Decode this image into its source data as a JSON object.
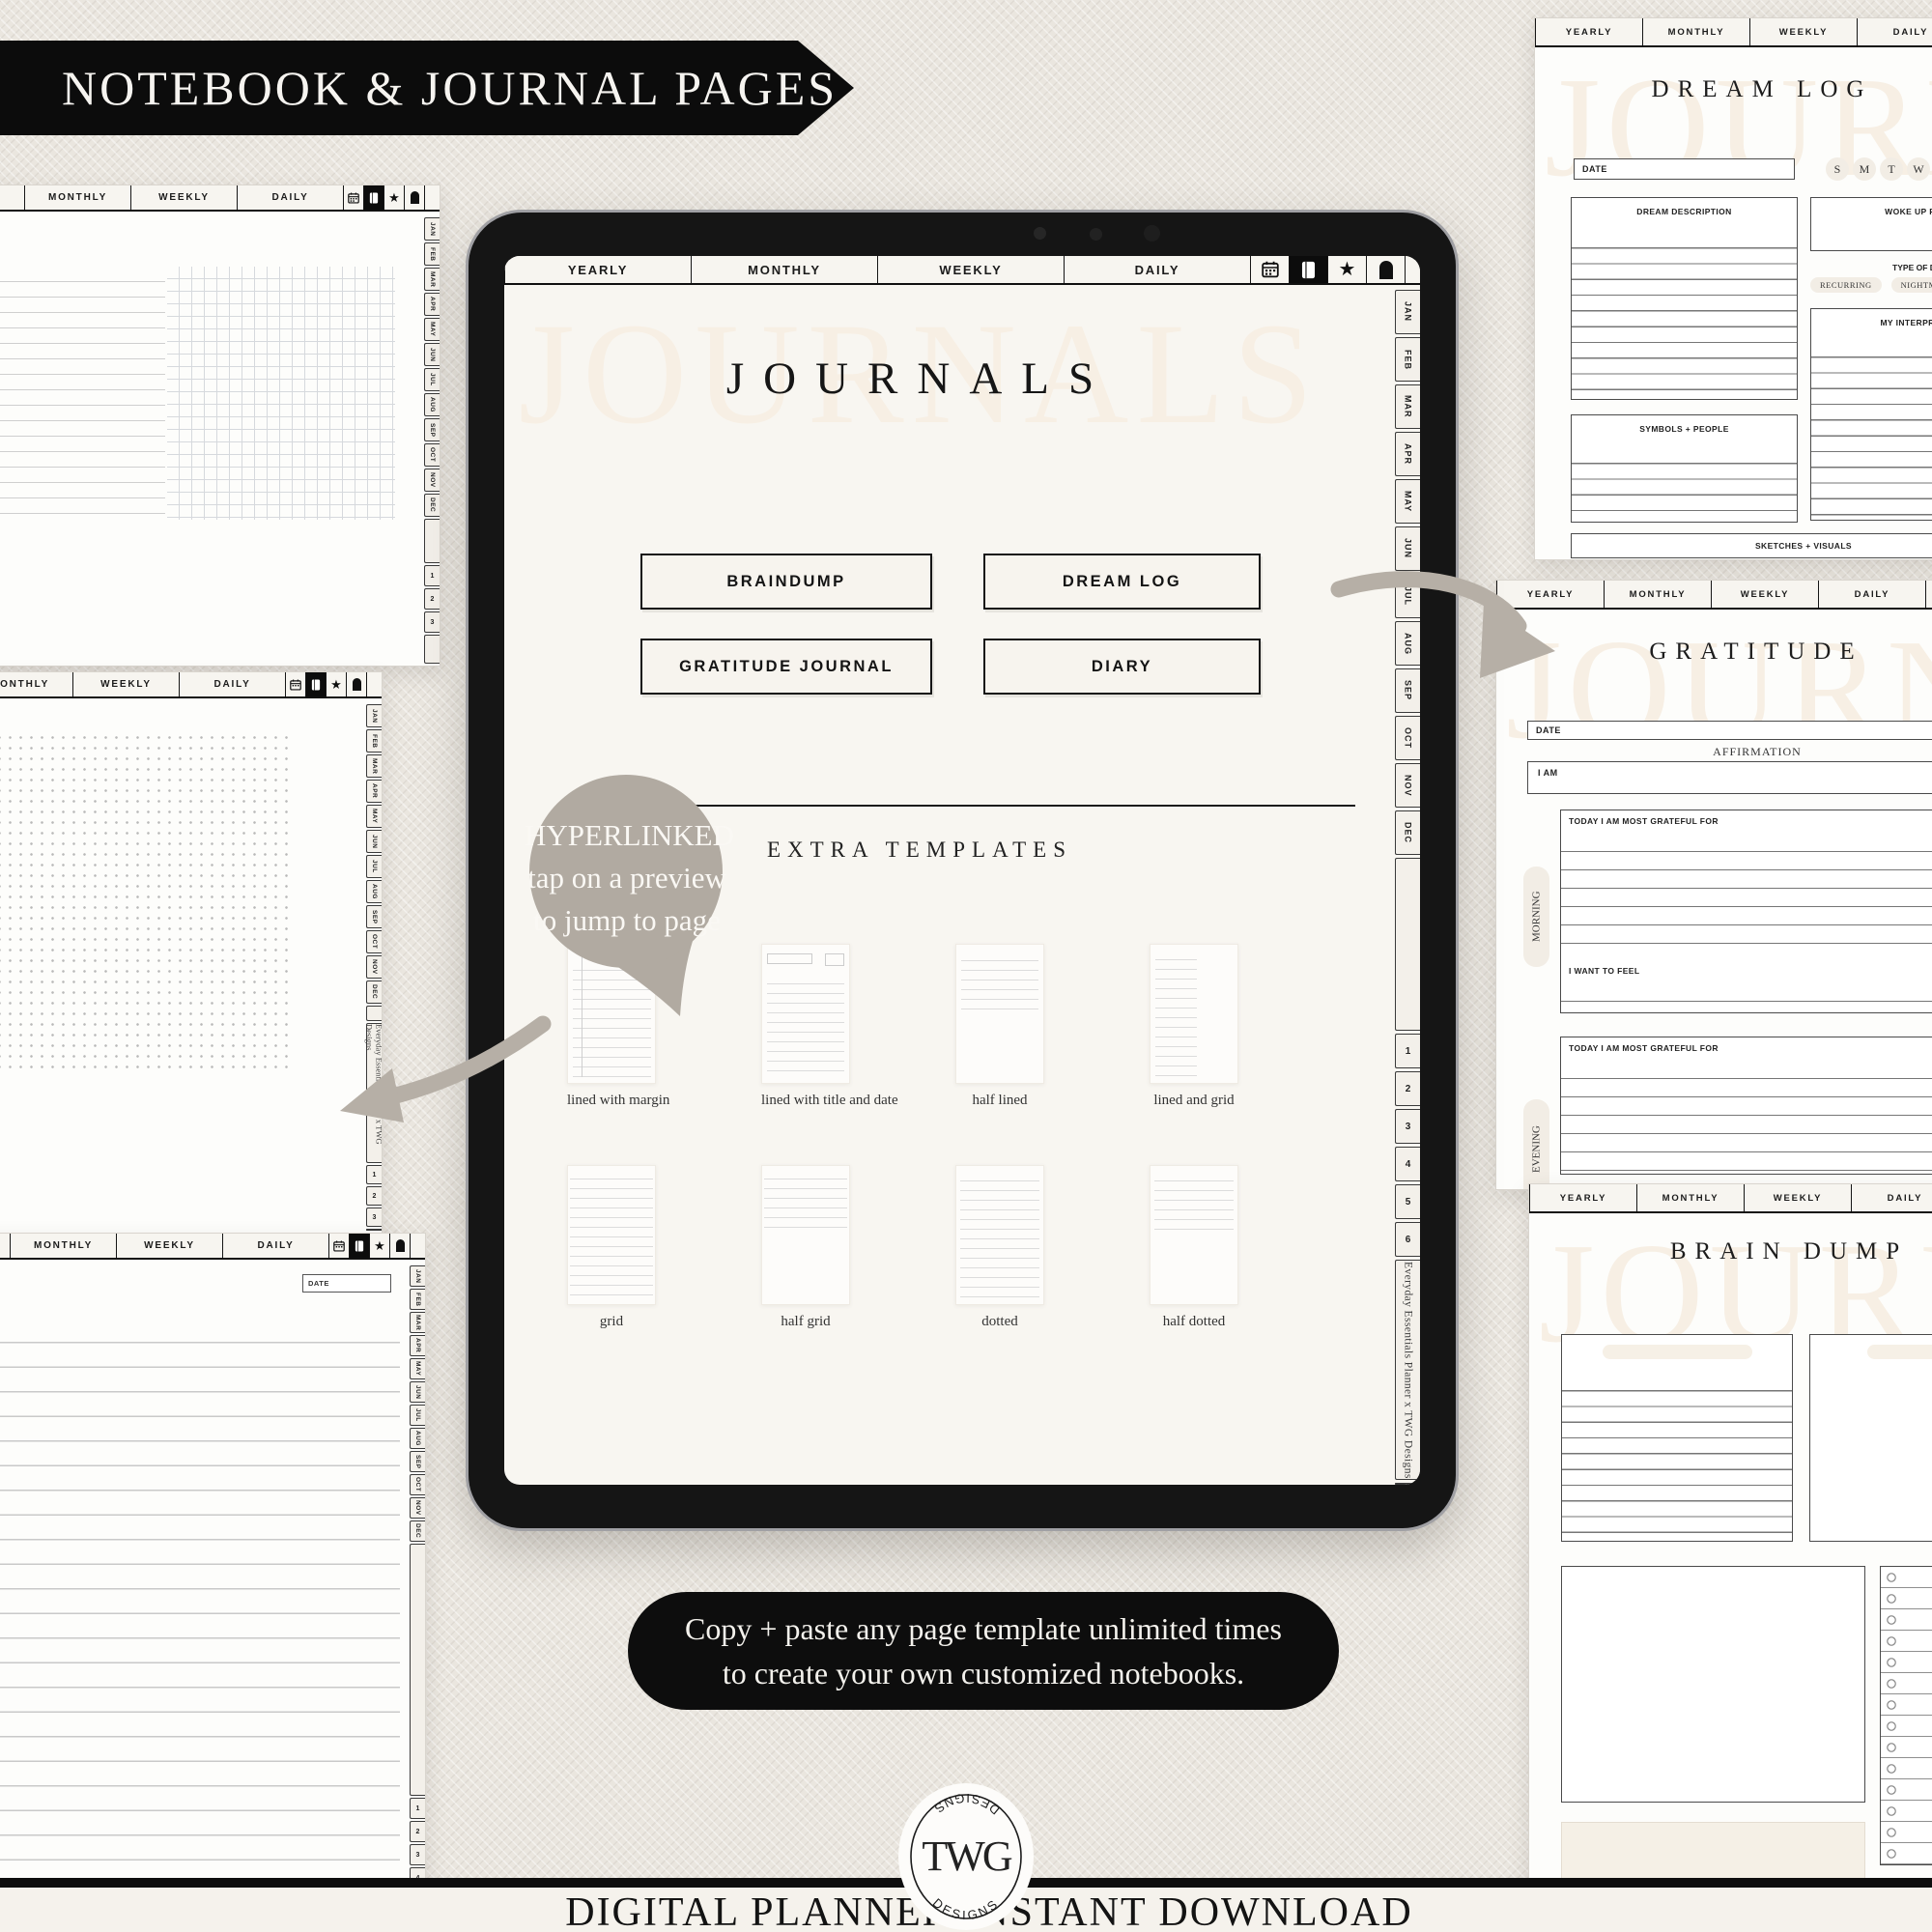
{
  "banner": {
    "title": "NOTEBOOK & JOURNAL PAGES"
  },
  "planner_tabs": [
    "YEARLY",
    "MONTHLY",
    "WEEKLY",
    "DAILY"
  ],
  "month_tabs": [
    "JAN",
    "FEB",
    "MAR",
    "APR",
    "MAY",
    "JUN",
    "JUL",
    "AUG",
    "SEP",
    "OCT",
    "NOV",
    "DEC"
  ],
  "ipad_number_tabs": [
    "1",
    "2",
    "3",
    "4",
    "5",
    "6"
  ],
  "pageb_number_tabs": [
    "1",
    "2",
    "3"
  ],
  "pagec_number_tabs": [
    "1",
    "2",
    "3",
    "4",
    "5"
  ],
  "credit": "Everyday Essentials Planner  x  TWG Designs",
  "ipad": {
    "watermark": "JOURNALS",
    "title": "JOURNALS",
    "buttons": [
      "BRAINDUMP",
      "DREAM LOG",
      "GRATITUDE JOURNAL",
      "DIARY"
    ],
    "extra_heading": "EXTRA TEMPLATES",
    "templates": [
      {
        "label": "lined with margin",
        "style": "s-lined-margin"
      },
      {
        "label": "lined with title and date",
        "style": "s-lined-title"
      },
      {
        "label": "half lined",
        "style": "s-half-lined"
      },
      {
        "label": "lined and grid",
        "style": "s-lined-grid"
      },
      {
        "label": "grid",
        "style": "s-grid"
      },
      {
        "label": "half grid",
        "style": "s-half-grid"
      },
      {
        "label": "dotted",
        "style": "s-dotted"
      },
      {
        "label": "half dotted",
        "style": "s-half-dotted"
      }
    ]
  },
  "bubble": {
    "line1": "HYPERLINKED",
    "line2": "tap on a preview",
    "line3": "to jump to page"
  },
  "dream_log": {
    "watermark": "JOURNALS",
    "title": "DREAM LOG",
    "date_label": "DATE",
    "day_circles": [
      "S",
      "M",
      "T",
      "W"
    ],
    "description_label": "DREAM DESCRIPTION",
    "woke_label": "WOKE UP FEELING",
    "type_label": "TYPE OF DREAM",
    "type_pills": [
      "RECURRING",
      "NIGHTMARE"
    ],
    "interpretation_label": "MY INTERPRETATION",
    "symbols_label": "SYMBOLS + PEOPLE",
    "sketches_label": "SKETCHES + VISUALS"
  },
  "gratitude": {
    "watermark": "JOURNALS",
    "title": "GRATITUDE",
    "date_label": "DATE",
    "affirmation_label": "AFFIRMATION",
    "iam_label": "I AM",
    "morning_label": "MORNING",
    "evening_label": "EVENING",
    "grateful_label": "TODAY I AM MOST GRATEFUL FOR",
    "feel_label": "I WANT TO FEEL"
  },
  "brain_dump": {
    "watermark": "JOURNALS",
    "title": "BRAIN DUMP"
  },
  "page_c": {
    "date_label": "DATE"
  },
  "note": {
    "line1": "Copy + paste any page template unlimited times",
    "line2": "to create your own customized notebooks."
  },
  "footer": {
    "left": "DIGITAL PLANNER",
    "right": "INSTANT DOWNLOAD"
  },
  "logo": {
    "monogram": "TWG",
    "designs": "DESIGNS"
  },
  "colors": {
    "banner_black": "#0c0c0c",
    "accent_taupe": "#b3aca3",
    "page_cream": "#f8f6f1",
    "watermark_cream": "#f7efe4"
  }
}
